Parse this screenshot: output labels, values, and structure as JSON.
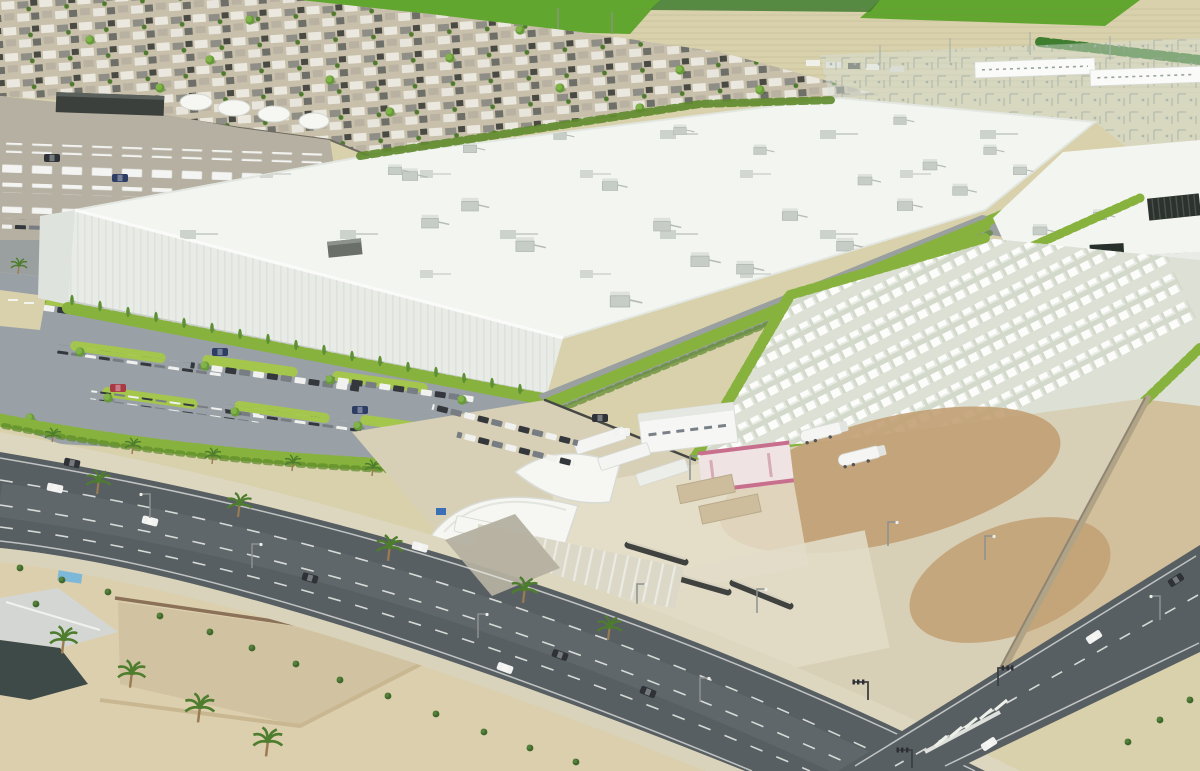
{
  "meta": {
    "domain": "Natural-Image",
    "image_type": "aerial architectural rendering",
    "description": "Bird's-eye rendering of a large white data-center campus in a desert suburb: main data hall with rooftop HVAC units, second data hall, transparent electrical substation, battery container yard, landscaped parking lot full of cars, construction staging yard with trailers and tents, wide boulevard with palm trees, desert lots, an irrigation canal, a dense single-family neighborhood and farm fields in the background.",
    "visible_text": ""
  },
  "colors": {
    "fieldTan": "#d8d1ac",
    "fieldGreen": "#61a62f",
    "fieldDeep": "#3f7d2f",
    "neighborhoodGround": "#c8c0ab",
    "lotGray": "#b6b0a2",
    "asphalt": "#9aa1a6",
    "perimeterRoad": "#9aa0a0",
    "roadDark": "#585f63",
    "sidewalk": "#ddd7c0",
    "sidewalkLower": "#d9d3bb",
    "desertSand": "#dccfad",
    "dirtBrown": "#c2a074",
    "dirtRight": "#d2bf9b",
    "constructionPad": "#d8d0b6",
    "concreteLight": "#e7e1cd",
    "roofWhite": "#f3f5f1",
    "facadeWhite": "#e9ece6",
    "yardGray": "#dde1d5",
    "substationTint": "rgba(214,224,214,0.45)",
    "hedge": "#87b23d",
    "hedgeDark": "#5e8a2b",
    "treeGreen": "#6f9e3b",
    "palmGreen": "#4e7d2e",
    "canalGreen": "#6f9c3a",
    "wallBrown": "#8a7158",
    "fenceDark": "#454844",
    "tentWhite": "#f6f7f3",
    "pinkBuilding": "#c86f8d",
    "tanContainer": "#cdbd9c",
    "grilleDark": "#2c332e",
    "carRed": "#a93945",
    "carNavy": "#2e3d63",
    "carDark": "#2f3338",
    "carWhite": "#f2f3f0",
    "blueBin": "#3a6fb5",
    "poolBlue": "#7db8d8"
  },
  "scene": {
    "background": {
      "farm_fields": "tan furrowed fields with bright green crop plots",
      "neighborhood": "dense single-family houses with gray, white and dark roofs",
      "substation": "semi-transparent electrical switchyard with lattice equipment and two white service buildings"
    },
    "campus": {
      "main_building": "very large white data hall with scattered rooftop HVAC units and green hedge walls",
      "second_building": "smaller white data hall with dark roof grille and dark entrance",
      "battery_yard": "rows of white battery storage containers in a fenced yard",
      "parking_lot": "landscaped parking lot with green islands, trees and many cars",
      "construction_yard": "dirt and concrete staging yard with office trailers, tents, containers, tanker trailers and fencing"
    },
    "foreground": {
      "main_road": "wide diagonal boulevard with lane dashes, cars, palms and streetlights",
      "side_road": "second diagonal road with crosswalk and traffic signals",
      "canal": "green irrigation swale between dirt berms",
      "house": "small residential house with walled dirt yard and shed",
      "desert": "sandy vacant lots with shrubs and palm trees"
    }
  }
}
